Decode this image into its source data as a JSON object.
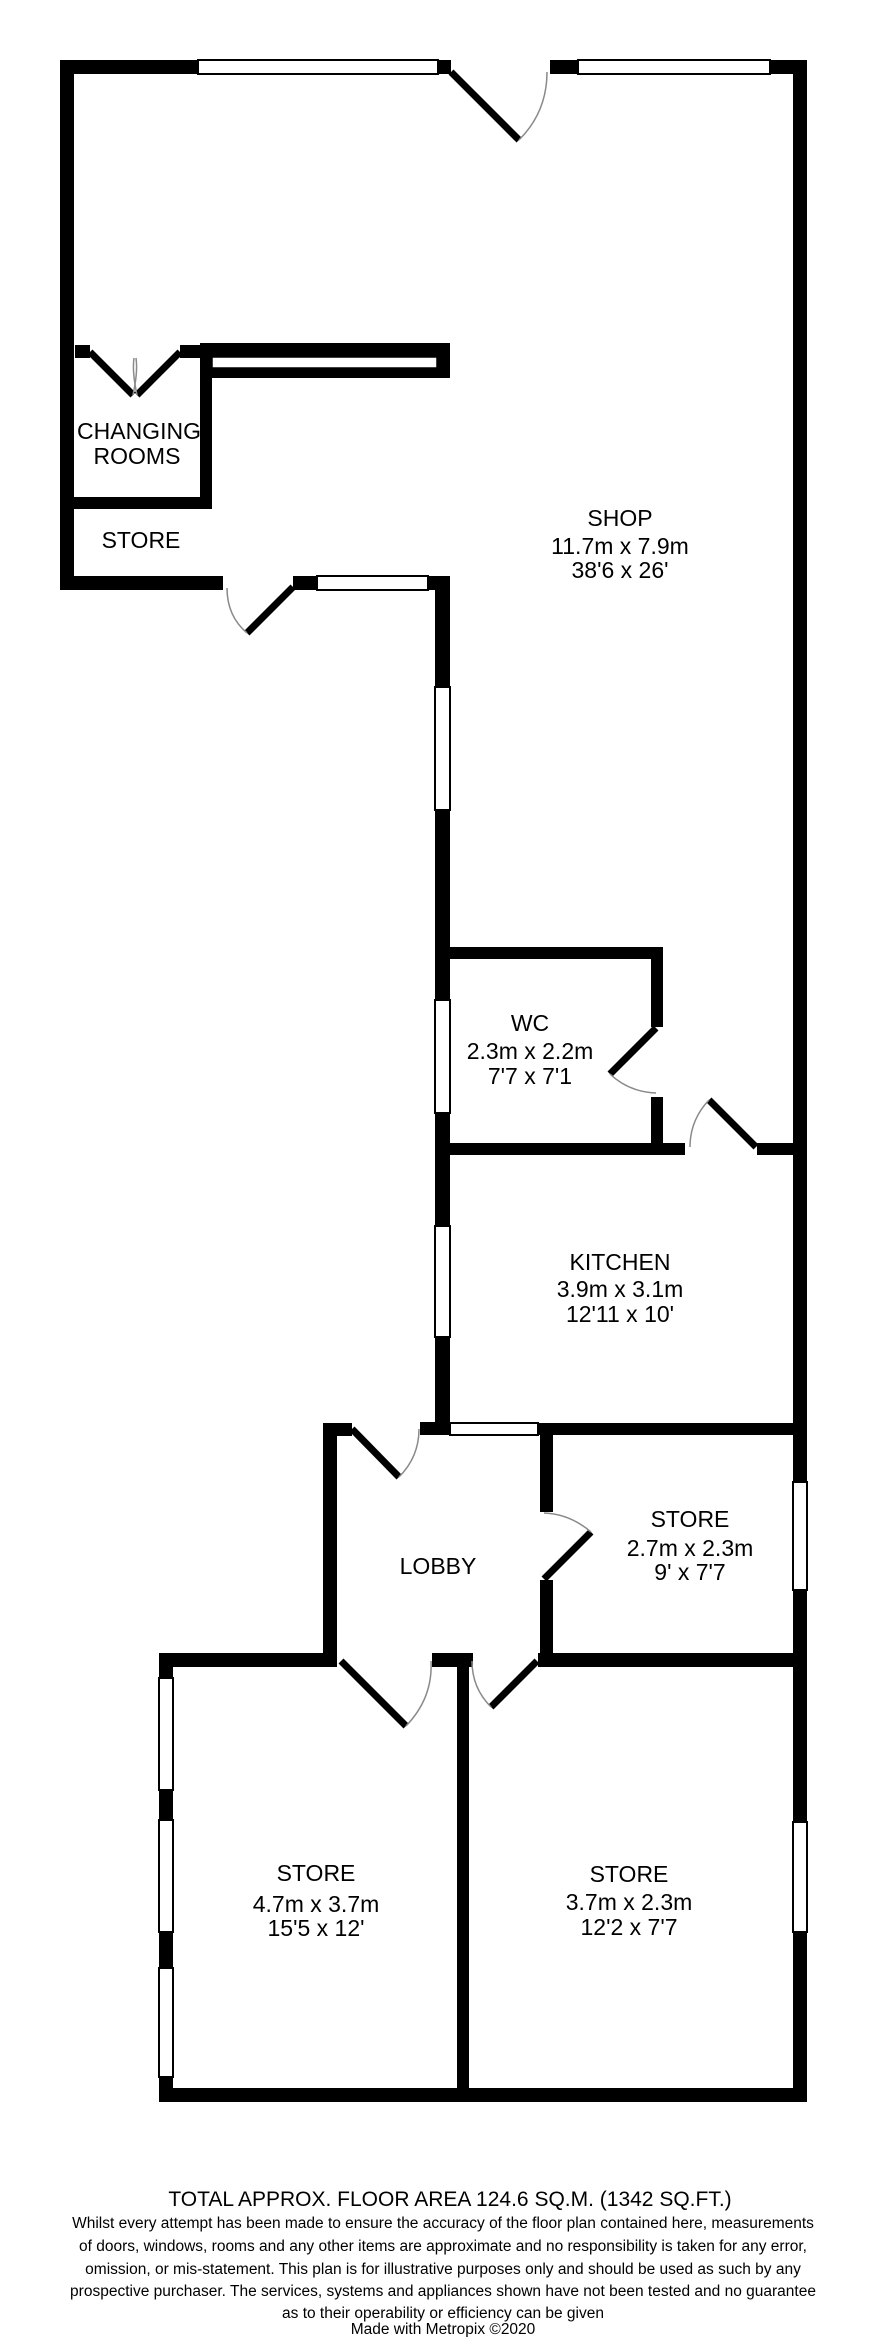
{
  "plan": {
    "rooms": {
      "shop": {
        "name": "SHOP",
        "metric": "11.7m x 7.9m",
        "imperial": "38'6 x 26'"
      },
      "changing": {
        "name_line1": "CHANGING",
        "name_line2": "ROOMS"
      },
      "store_top": {
        "name": "STORE"
      },
      "wc": {
        "name": "WC",
        "metric": "2.3m x 2.2m",
        "imperial": "7'7 x 7'1"
      },
      "kitchen": {
        "name": "KITCHEN",
        "metric": "3.9m x 3.1m",
        "imperial": "12'11 x 10'"
      },
      "store_mid": {
        "name": "STORE",
        "metric": "2.7m x 2.3m",
        "imperial": "9' x 7'7"
      },
      "lobby": {
        "name": "LOBBY"
      },
      "store_bl": {
        "name": "STORE",
        "metric": "4.7m x 3.7m",
        "imperial": "15'5 x 12'"
      },
      "store_br": {
        "name": "STORE",
        "metric": "3.7m x 2.3m",
        "imperial": "12'2 x 7'7"
      }
    }
  },
  "footer": {
    "total_area": "TOTAL APPROX. FLOOR AREA 124.6 SQ.M. (1342 SQ.FT.)",
    "disclaimer_lines": [
      "Whilst every attempt has been made to ensure the accuracy of the floor plan contained here, measurements",
      "of doors, windows, rooms and any other items are approximate and no responsibility is taken for any error,",
      "omission, or mis-statement. This plan is for illustrative purposes only and should be used as such by any",
      "prospective purchaser. The services, systems and appliances shown have not been tested and no guarantee",
      "as to their operability or efficiency can be given"
    ],
    "credit": "Made with Metropix ©2020"
  },
  "colors": {
    "wall": "#000000",
    "background": "#ffffff",
    "door_swing": "#8a8a8a"
  }
}
